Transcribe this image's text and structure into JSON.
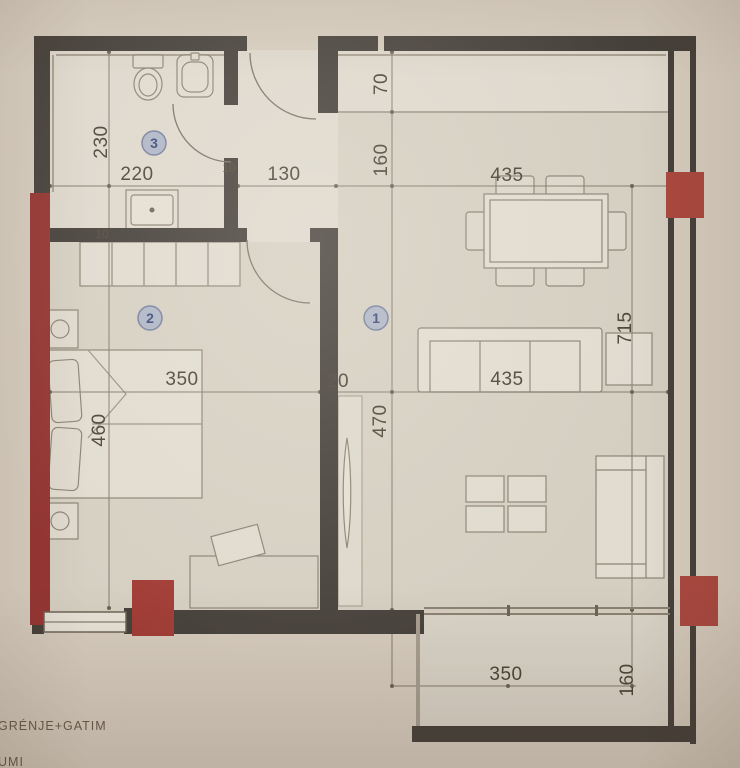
{
  "plan_type": "apartment-floor-plan",
  "rooms": {
    "living_dining_kitchen": {
      "number": "1"
    },
    "bedroom": {
      "number": "2"
    },
    "bathroom": {
      "number": "3"
    }
  },
  "dims": {
    "bath_depth": "230",
    "bath_width": "220",
    "hall_width": "130",
    "vestibule_depth": "70",
    "entry_depth": "160",
    "living_width_top": "435",
    "living_length": "715",
    "bedroom_width": "350",
    "bedroom_depth": "460",
    "living_depth": "470",
    "sofa_line": "435",
    "wall_thickness": "20",
    "wall_small_a": "10",
    "wall_small_b": "10",
    "balcony_width": "350",
    "balcony_depth": "160"
  },
  "legend": {
    "line1": "GRÉNJE+GATIM",
    "line2": "UMI"
  },
  "colors": {
    "paper": "#d7cdbf",
    "wall": "#454039",
    "red_wall": "#9d3330",
    "red_block": "#b2463c",
    "dim_text": "#4c4537",
    "circle_fill": "#aeb6c9"
  }
}
